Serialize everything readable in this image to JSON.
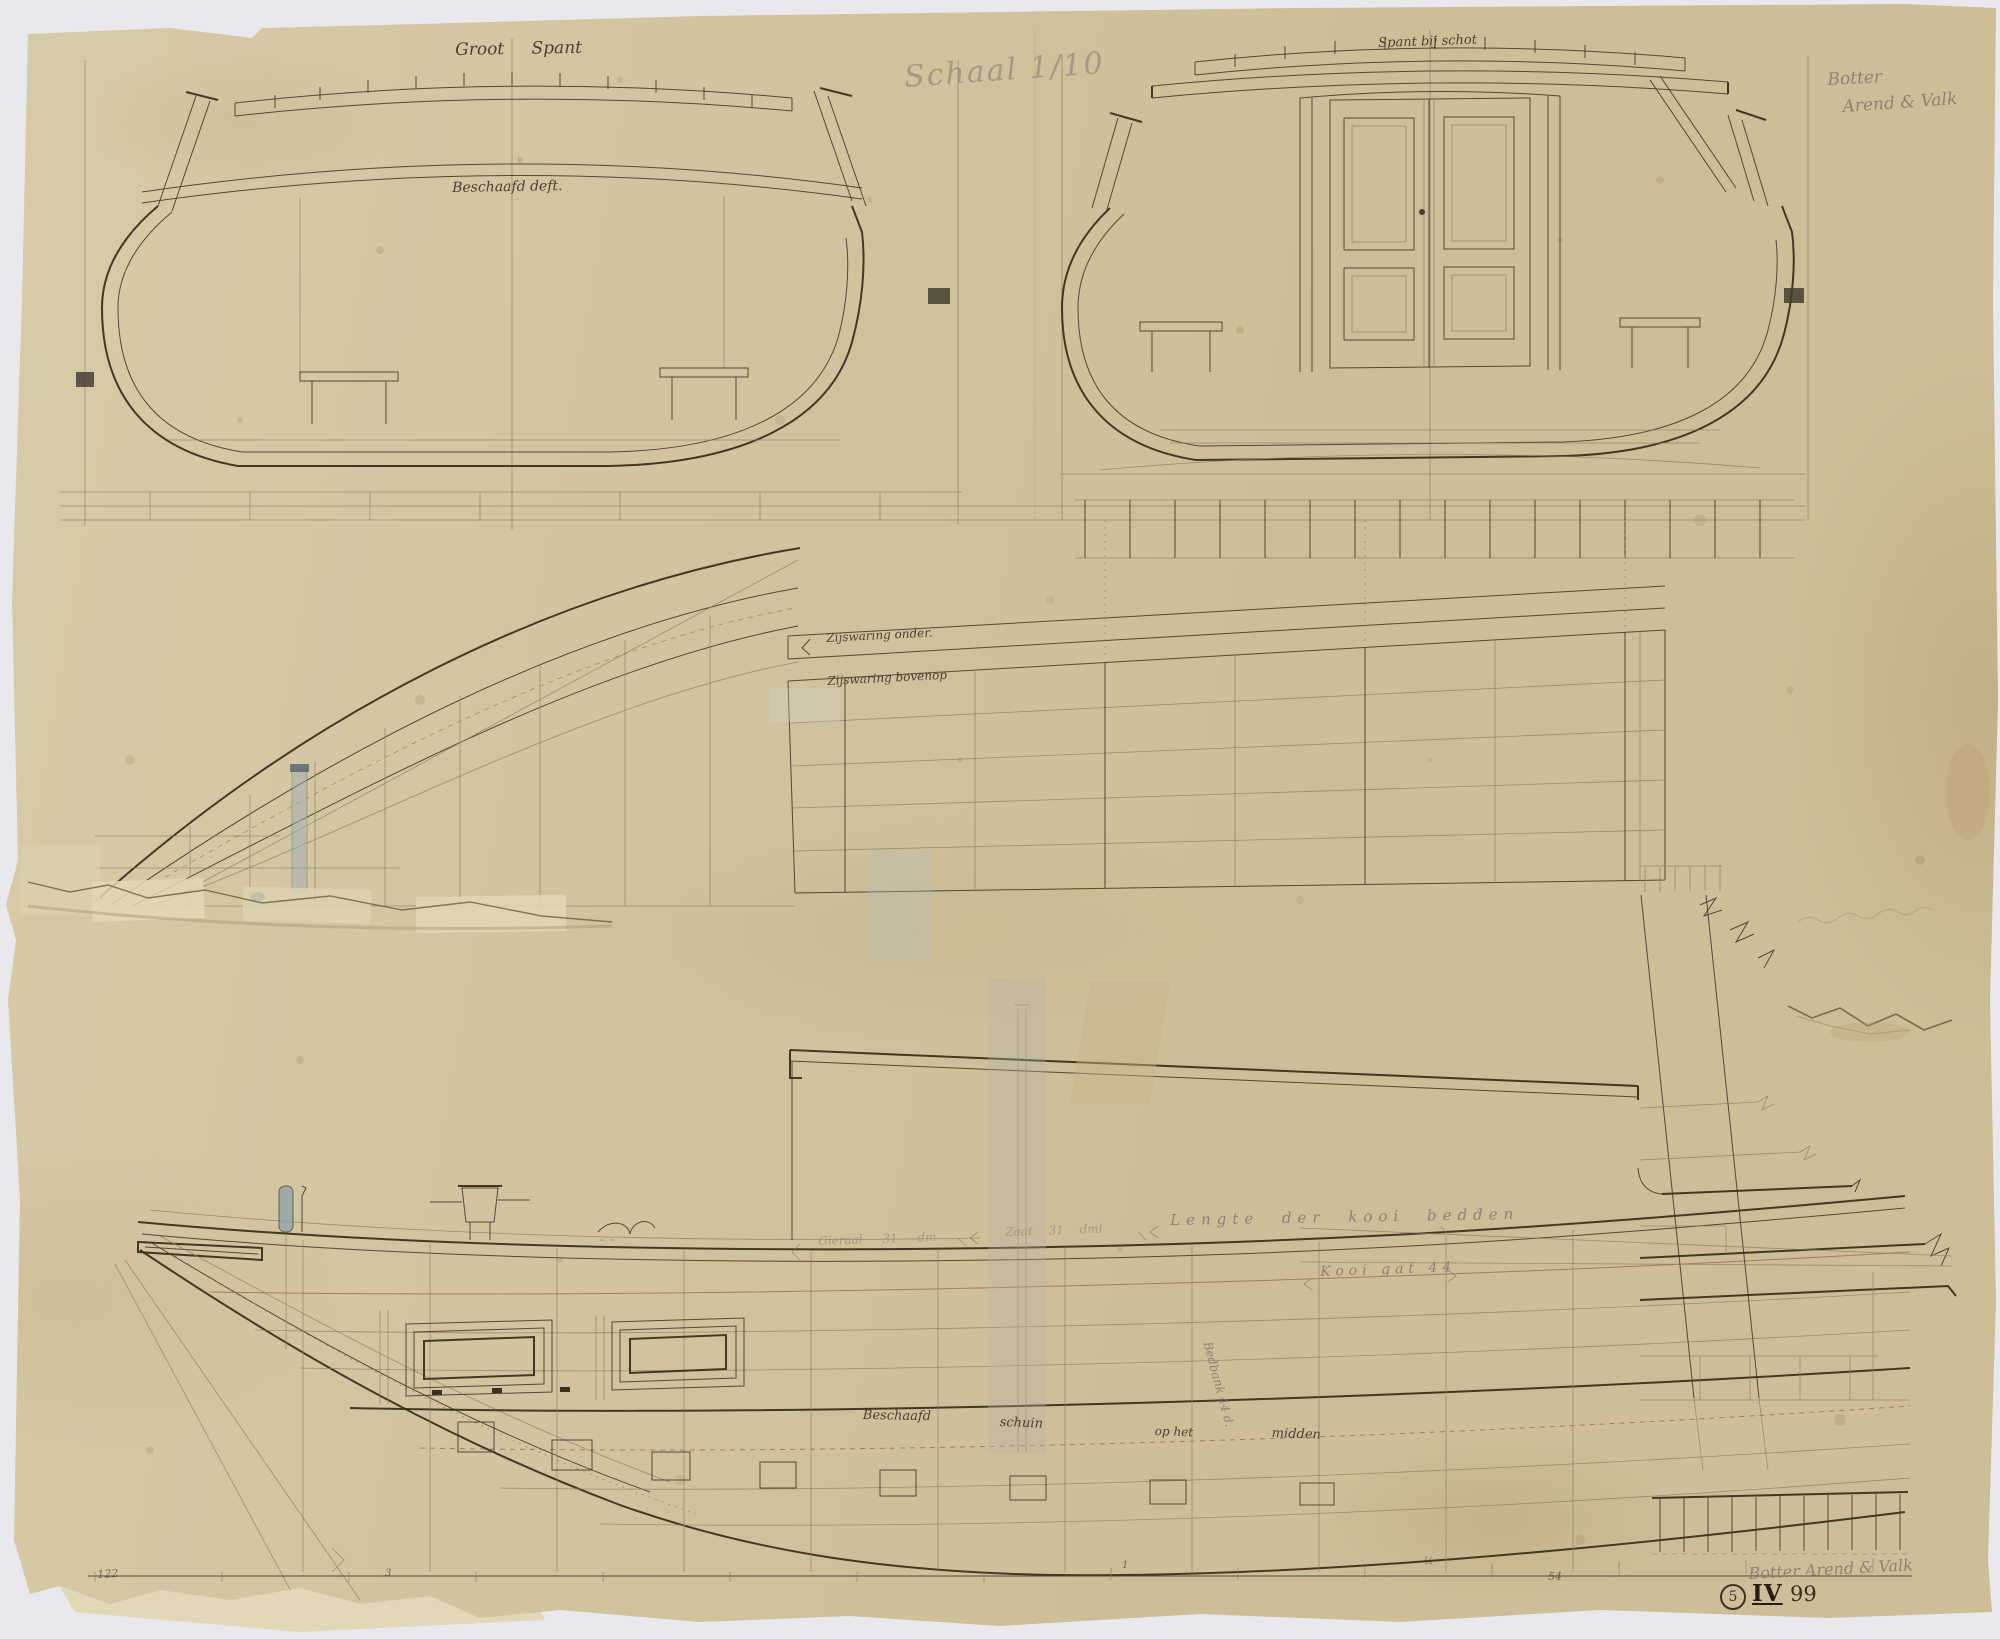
{
  "colors": {
    "background": "#e9e8ec",
    "paper": "#d5c7a1",
    "ink": "#4a4136",
    "pencil": "#8d8276",
    "red_line": "#a05844",
    "tape": "#b6b1a8",
    "seal_green": "#2f6f60"
  },
  "annotations": {
    "section_left_title": "Groot Spant",
    "scale_note": "Schaal 1/10",
    "section_right_title": "Spant bij schot",
    "corner_note_line1": "Botter",
    "corner_note_line2": "Arend & Valk",
    "deck_note": "Beschaafd deft.",
    "wale_lower": "Zijswaring onder.",
    "wale_upper": "Zijswaring bovenop",
    "dim_fore": "Gieraal  31 dm",
    "dim_mid": "Zaat  31 dml",
    "dim_berths": "Lengte der kooi bedden",
    "dim_berth_opening": "Kooi gat 44",
    "dim_bedbank": "Bedbank 44 d.",
    "hold_note_1": "Beschaafd",
    "hold_note_2": "schuin",
    "hold_note_3": "op het",
    "hold_note_4": "midden",
    "bottom_note": "Botter Arend & Valk",
    "stamp_number": "5",
    "stamp_roman": "IV",
    "stamp_year": "99",
    "tick_a": "122",
    "tick_b": "3",
    "tick_c": "1",
    "tick_d": "½",
    "tick_e": "54"
  }
}
